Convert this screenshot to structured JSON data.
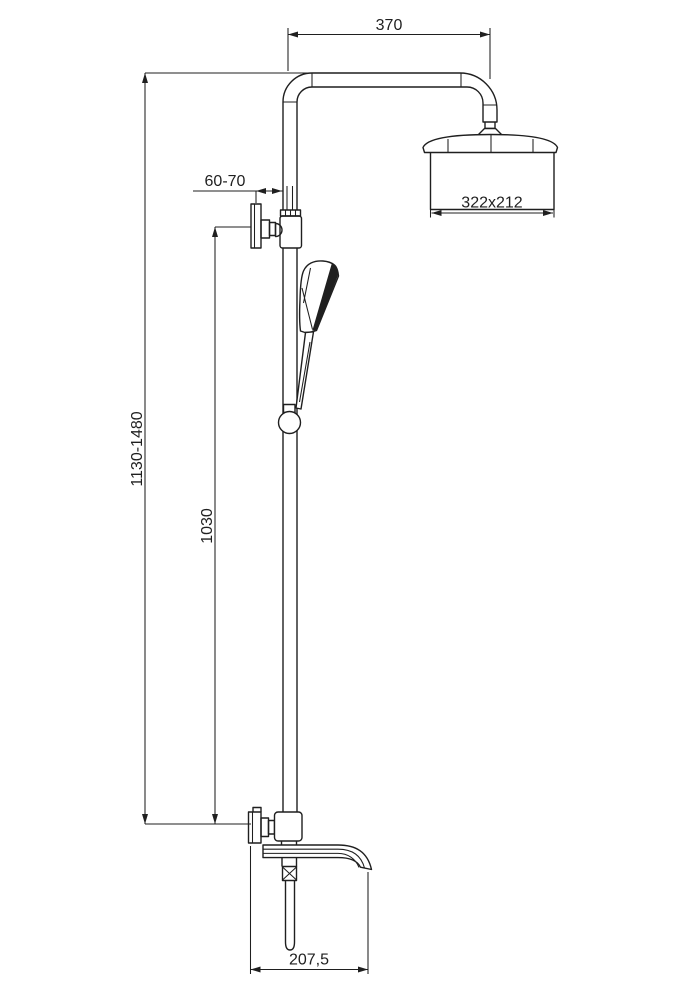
{
  "dimensions": {
    "arm_reach": "370",
    "wall_offset": "60-70",
    "head_size": "322x212",
    "overall_height": "1130-1480",
    "rail_span": "1030",
    "spout_reach": "207,5"
  },
  "colors": {
    "ink": "#1f1f1f",
    "paper": "#ffffff"
  }
}
